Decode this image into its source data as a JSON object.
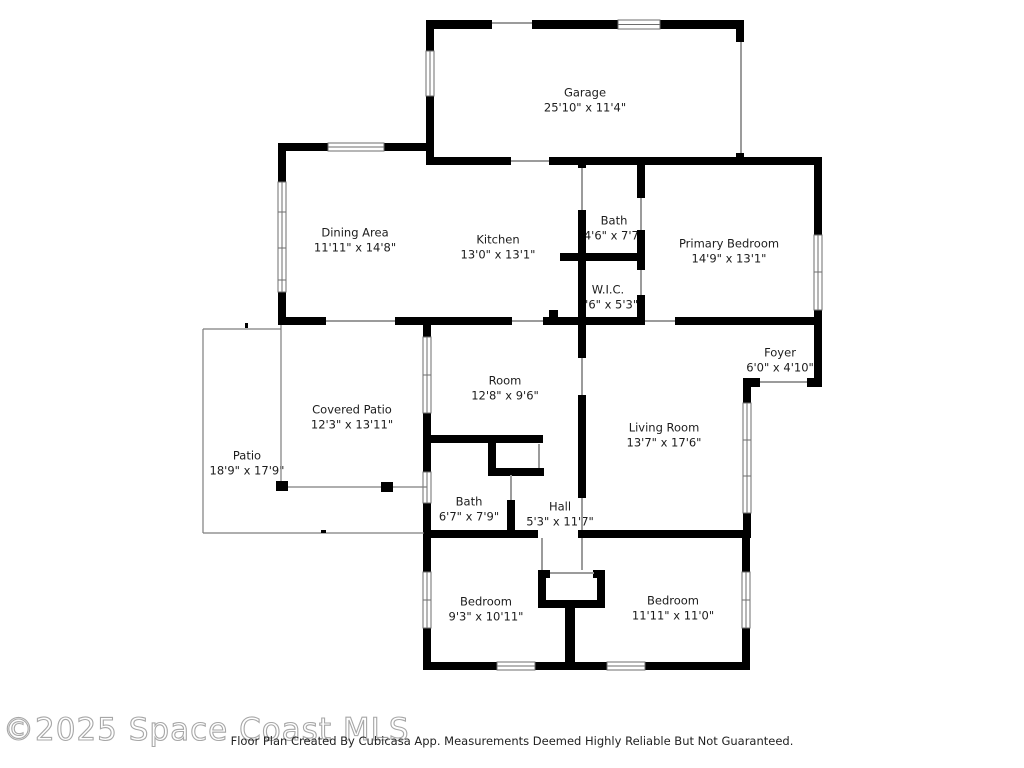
{
  "watermark": {
    "text": "©2025 Space Coast MLS",
    "color": "#a7a7a7"
  },
  "disclaimer": {
    "text": "Floor Plan Created By Cubicasa App. Measurements Deemed Highly Reliable But Not Guaranteed."
  },
  "floor_plan": {
    "colors": {
      "wall": "#000000",
      "background": "#ffffff",
      "label_text": "#1c1c1c",
      "door_line": "#9b9b9b",
      "patio_line": "#7d7d7d"
    },
    "rooms": [
      {
        "id": "garage",
        "name": "Garage",
        "dims": "25'10\" x 11'4\"",
        "cx": 585,
        "cy": 100
      },
      {
        "id": "dining-area",
        "name": "Dining Area",
        "dims": "11'11\" x 14'8\"",
        "cx": 355,
        "cy": 240
      },
      {
        "id": "kitchen",
        "name": "Kitchen",
        "dims": "13'0\" x 13'1\"",
        "cx": 498,
        "cy": 247
      },
      {
        "id": "bath-upper",
        "name": "Bath",
        "dims": "4'6\" x 7'7\"",
        "cx": 614,
        "cy": 228
      },
      {
        "id": "primary-bedroom",
        "name": "Primary Bedroom",
        "dims": "14'9\" x 13'1\"",
        "cx": 729,
        "cy": 251
      },
      {
        "id": "wic",
        "name": "W.I.C.",
        "dims": "4'6\" x 5'3\"",
        "cx": 608,
        "cy": 297
      },
      {
        "id": "foyer",
        "name": "Foyer",
        "dims": "6'0\" x 4'10\"",
        "cx": 780,
        "cy": 360
      },
      {
        "id": "room",
        "name": "Room",
        "dims": "12'8\" x 9'6\"",
        "cx": 505,
        "cy": 388
      },
      {
        "id": "covered-patio",
        "name": "Covered Patio",
        "dims": "12'3\" x 13'11\"",
        "cx": 352,
        "cy": 417
      },
      {
        "id": "patio",
        "name": "Patio",
        "dims": "18'9\" x 17'9\"",
        "cx": 247,
        "cy": 463
      },
      {
        "id": "living-room",
        "name": "Living Room",
        "dims": "13'7\" x 17'6\"",
        "cx": 664,
        "cy": 435
      },
      {
        "id": "bath-lower",
        "name": "Bath",
        "dims": "6'7\" x 7'9\"",
        "cx": 469,
        "cy": 509
      },
      {
        "id": "hall",
        "name": "Hall",
        "dims": "5'3\" x 11'7\"",
        "cx": 560,
        "cy": 514
      },
      {
        "id": "bedroom-left",
        "name": "Bedroom",
        "dims": "9'3\" x 10'11\"",
        "cx": 486,
        "cy": 609
      },
      {
        "id": "bedroom-right",
        "name": "Bedroom",
        "dims": "11'11\" x 11'0\"",
        "cx": 673,
        "cy": 608
      }
    ]
  }
}
